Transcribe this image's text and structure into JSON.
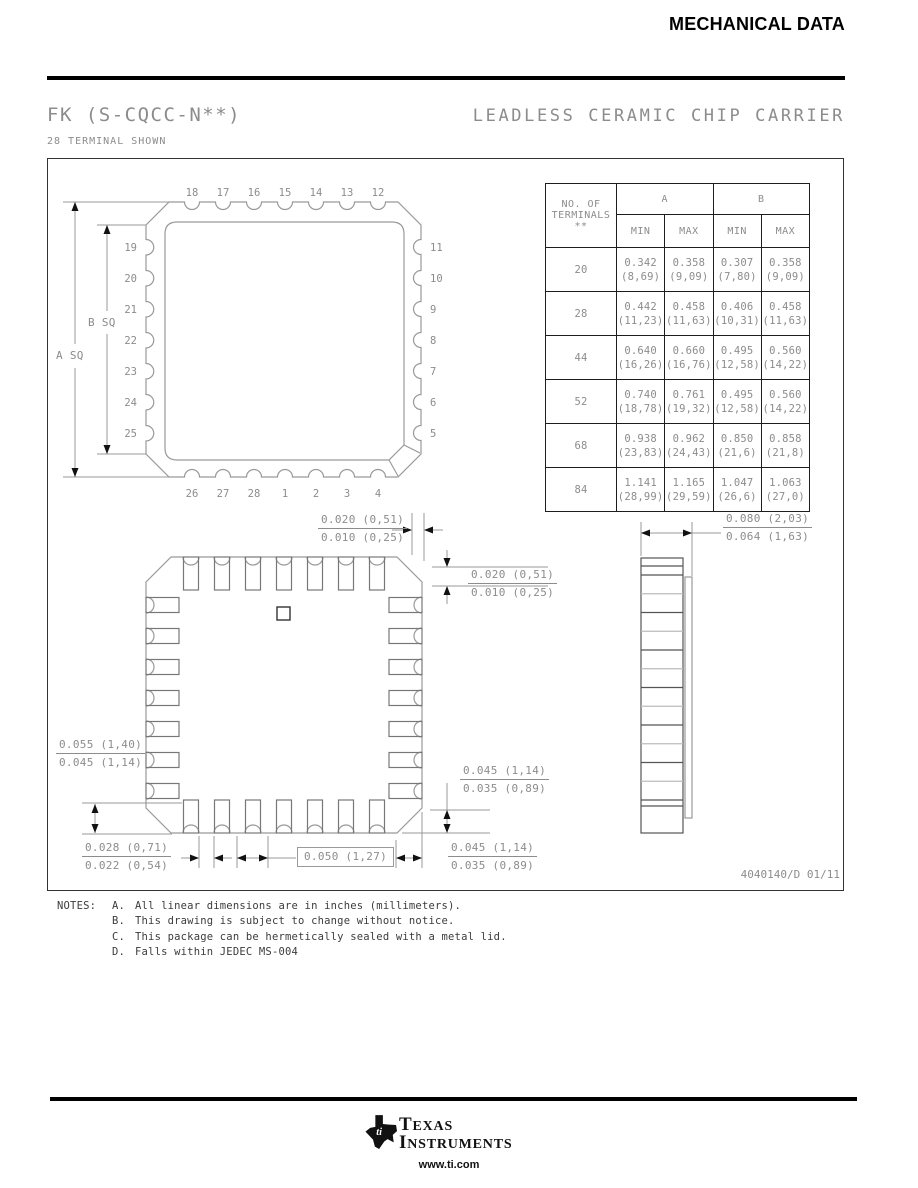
{
  "header": {
    "title": "MECHANICAL DATA"
  },
  "title_block": {
    "package_code": "FK (S-CQCC-N**)",
    "package_type": "LEADLESS CERAMIC CHIP CARRIER",
    "subtitle": "28 TERMINAL SHOWN"
  },
  "drawing": {
    "doc_number": "4040140/D 01/11",
    "labels": {
      "a_sq": "A SQ",
      "b_sq": "B SQ"
    },
    "pins": {
      "top": [
        "18",
        "17",
        "16",
        "15",
        "14",
        "13",
        "12"
      ],
      "right": [
        "11",
        "10",
        "9",
        "8",
        "7",
        "6",
        "5"
      ],
      "bottom": [
        "26",
        "27",
        "28",
        "1",
        "2",
        "3",
        "4"
      ],
      "left": [
        "19",
        "20",
        "21",
        "22",
        "23",
        "24",
        "25"
      ]
    },
    "dims": {
      "top_gap": [
        "0.020 (0,51)",
        "0.010 (0,25)"
      ],
      "right_gap": [
        "0.020 (0,51)",
        "0.010 (0,25)"
      ],
      "thickness": [
        "0.080 (2,03)",
        "0.064 (1,63)"
      ],
      "left_height": [
        "0.055 (1,40)",
        "0.045 (1,14)"
      ],
      "cast_width": [
        "0.028 (0,71)",
        "0.022 (0,54)"
      ],
      "pitch": "0.050 (1,27)",
      "corner_height": [
        "0.045 (1,14)",
        "0.035 (0,89)"
      ],
      "corner_width": [
        "0.045 (1,14)",
        "0.035 (0,89)"
      ]
    }
  },
  "table": {
    "col_header_lines": [
      "NO. OF",
      "TERMINALS",
      "**"
    ],
    "group_headers": [
      "A",
      "B"
    ],
    "sub_headers": [
      "MIN",
      "MAX",
      "MIN",
      "MAX"
    ],
    "rows": [
      {
        "terminals": "20",
        "values": [
          [
            "0.342",
            "(8,69)"
          ],
          [
            "0.358",
            "(9,09)"
          ],
          [
            "0.307",
            "(7,80)"
          ],
          [
            "0.358",
            "(9,09)"
          ]
        ]
      },
      {
        "terminals": "28",
        "values": [
          [
            "0.442",
            "(11,23)"
          ],
          [
            "0.458",
            "(11,63)"
          ],
          [
            "0.406",
            "(10,31)"
          ],
          [
            "0.458",
            "(11,63)"
          ]
        ]
      },
      {
        "terminals": "44",
        "values": [
          [
            "0.640",
            "(16,26)"
          ],
          [
            "0.660",
            "(16,76)"
          ],
          [
            "0.495",
            "(12,58)"
          ],
          [
            "0.560",
            "(14,22)"
          ]
        ]
      },
      {
        "terminals": "52",
        "values": [
          [
            "0.740",
            "(18,78)"
          ],
          [
            "0.761",
            "(19,32)"
          ],
          [
            "0.495",
            "(12,58)"
          ],
          [
            "0.560",
            "(14,22)"
          ]
        ]
      },
      {
        "terminals": "68",
        "values": [
          [
            "0.938",
            "(23,83)"
          ],
          [
            "0.962",
            "(24,43)"
          ],
          [
            "0.850",
            "(21,6)"
          ],
          [
            "0.858",
            "(21,8)"
          ]
        ]
      },
      {
        "terminals": "84",
        "values": [
          [
            "1.141",
            "(28,99)"
          ],
          [
            "1.165",
            "(29,59)"
          ],
          [
            "1.047",
            "(26,6)"
          ],
          [
            "1.063",
            "(27,0)"
          ]
        ]
      }
    ]
  },
  "notes": {
    "label": "NOTES:",
    "items": [
      {
        "key": "A.",
        "text": "All linear dimensions are in inches (millimeters)."
      },
      {
        "key": "B.",
        "text": "This drawing is subject to change without notice."
      },
      {
        "key": "C.",
        "text": "This package can be hermetically sealed with a metal lid."
      },
      {
        "key": "D.",
        "text": "Falls within JEDEC MS-004"
      }
    ]
  },
  "footer": {
    "brand_top": "TEXAS",
    "brand_bottom": "INSTRUMENTS",
    "monogram": "ti",
    "url": "www.ti.com"
  },
  "colors": {
    "ink": "#000000",
    "cad_line": "#999999",
    "cad_text": "#8c8c8c"
  }
}
